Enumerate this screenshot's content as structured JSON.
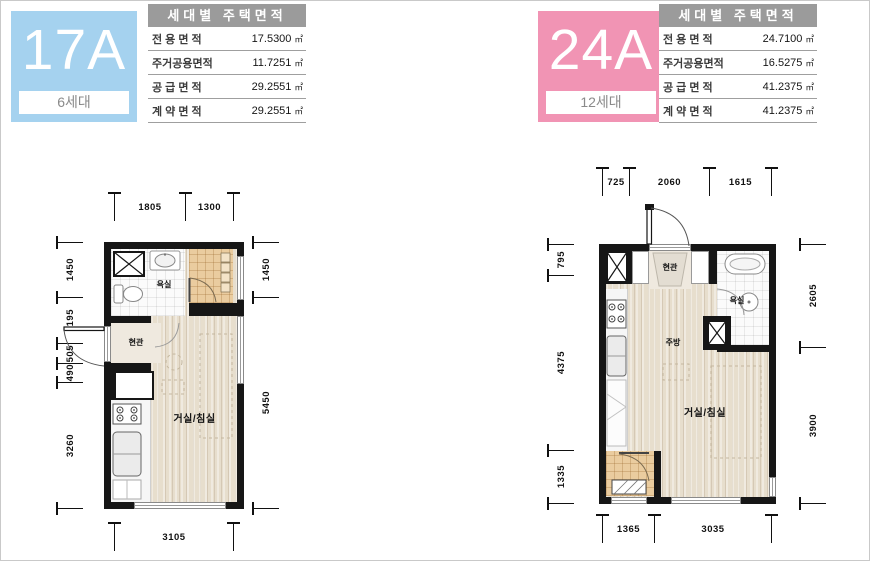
{
  "units": [
    {
      "code": "17A",
      "households": "6세대",
      "accent": "#a5d2ef",
      "table": {
        "title": "세대별 주택면적",
        "rows": [
          {
            "label": "전 용 면 적",
            "value": "17.5300",
            "unit": "㎡"
          },
          {
            "label": "주거공용면적",
            "value": "11.7251",
            "unit": "㎡"
          },
          {
            "label": "공 급 면 적",
            "value": "29.2551",
            "unit": "㎡"
          },
          {
            "label": "계 약 면 적",
            "value": "29.2551",
            "unit": "㎡"
          }
        ]
      },
      "rooms": {
        "bathroom": "욕실",
        "entrance": "현관",
        "living": "거실/침실"
      },
      "dims": {
        "top": [
          "1805",
          "1300"
        ],
        "left": [
          "1450",
          "1195",
          "505",
          "490",
          "3260"
        ],
        "right": [
          "1450",
          "5450"
        ],
        "bottom": [
          "3105"
        ]
      }
    },
    {
      "code": "24A",
      "households": "12세대",
      "accent": "#f194b4",
      "table": {
        "title": "세대별 주택면적",
        "rows": [
          {
            "label": "전 용 면 적",
            "value": "24.7100",
            "unit": "㎡"
          },
          {
            "label": "주거공용면적",
            "value": "16.5275",
            "unit": "㎡"
          },
          {
            "label": "공 급 면 적",
            "value": "41.2375",
            "unit": "㎡"
          },
          {
            "label": "계 약 면 적",
            "value": "41.2375",
            "unit": "㎡"
          }
        ]
      },
      "rooms": {
        "bathroom": "욕실",
        "entrance": "현관",
        "kitchen": "주방",
        "living": "거실/침실"
      },
      "dims": {
        "top": [
          "725",
          "2060",
          "1615"
        ],
        "left": [
          "795",
          "4375",
          "1335"
        ],
        "right": [
          "2605",
          "3900"
        ],
        "bottom": [
          "1365",
          "3035"
        ]
      }
    }
  ]
}
